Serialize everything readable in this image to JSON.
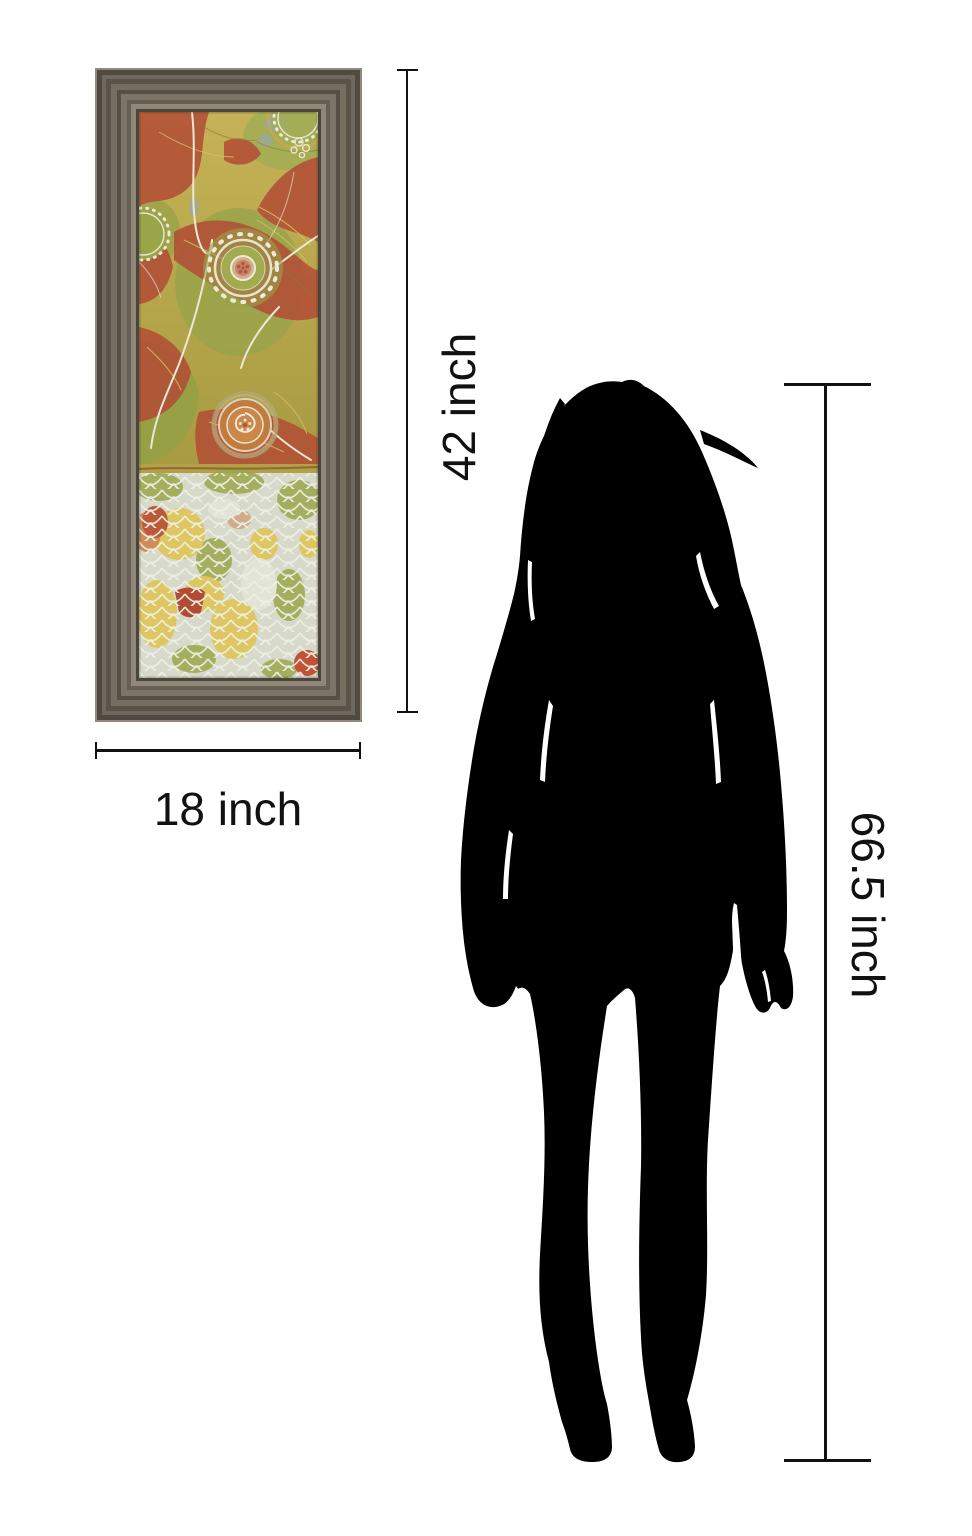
{
  "labels": {
    "art_height": "42 inch",
    "art_width": "18 inch",
    "person_height": "66.5 inch"
  },
  "artwork": {
    "name": "abstract medallion panel print in ridged wood frame",
    "frame_color": "#6e675c",
    "frame_lip_color": "#8f8878",
    "palette": {
      "gold": "#c4b155",
      "olive_green": "#9aa449",
      "brick_red": "#b24f36",
      "orange": "#c07c3e",
      "cream": "#ece7d6",
      "scallop_ground": "#d7d9cb",
      "blue_gray": "#93a7b8"
    }
  },
  "silhouette": {
    "name": "standing woman silhouette",
    "color": "#000000"
  },
  "annotation": {
    "line_color": "#111111"
  }
}
